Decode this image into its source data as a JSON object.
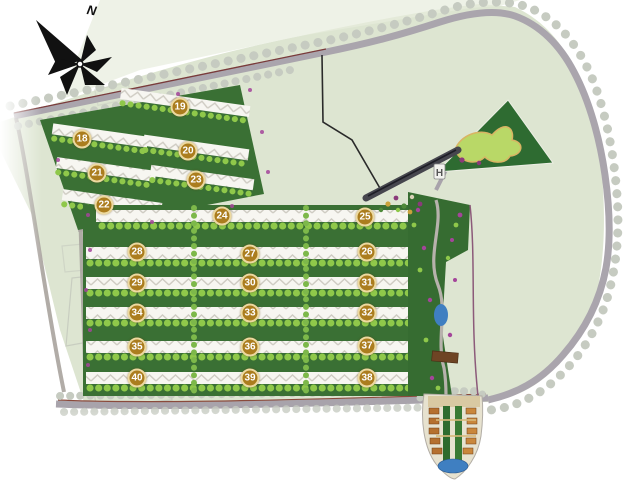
{
  "map": {
    "compass": {
      "label": "N"
    },
    "entrance_marker": {
      "label": "H"
    },
    "building_markers": [
      {
        "label": "18",
        "x": 82,
        "y": 139
      },
      {
        "label": "19",
        "x": 180,
        "y": 107
      },
      {
        "label": "20",
        "x": 188,
        "y": 151
      },
      {
        "label": "21",
        "x": 97,
        "y": 173
      },
      {
        "label": "22",
        "x": 104,
        "y": 205
      },
      {
        "label": "23",
        "x": 196,
        "y": 180
      },
      {
        "label": "24",
        "x": 222,
        "y": 216
      },
      {
        "label": "25",
        "x": 365,
        "y": 217
      },
      {
        "label": "26",
        "x": 367,
        "y": 252
      },
      {
        "label": "27",
        "x": 250,
        "y": 254
      },
      {
        "label": "28",
        "x": 137,
        "y": 252
      },
      {
        "label": "29",
        "x": 137,
        "y": 283
      },
      {
        "label": "30",
        "x": 250,
        "y": 283
      },
      {
        "label": "31",
        "x": 367,
        "y": 283
      },
      {
        "label": "32",
        "x": 367,
        "y": 313
      },
      {
        "label": "33",
        "x": 250,
        "y": 313
      },
      {
        "label": "34",
        "x": 137,
        "y": 313
      },
      {
        "label": "35",
        "x": 137,
        "y": 347
      },
      {
        "label": "36",
        "x": 250,
        "y": 347
      },
      {
        "label": "37",
        "x": 367,
        "y": 346
      },
      {
        "label": "38",
        "x": 367,
        "y": 378
      },
      {
        "label": "39",
        "x": 250,
        "y": 378
      },
      {
        "label": "40",
        "x": 137,
        "y": 378
      }
    ],
    "colors": {
      "site_background": "#dde5d1",
      "road": "#aaa5ad",
      "tree_dot": "#c6cbc1",
      "building_row": "#f7f6f1",
      "greenery_dark": "#3a7034",
      "greenery_light": "#8fc84a",
      "marker_fill": "#ab7d1e",
      "marker_ring": "#ecd9a0",
      "marker_text": "#ffffff",
      "park_dark": "#2e6b31",
      "park_lawn": "#b9d867",
      "water": "#3f7fc1",
      "flower_accent": "#a4459a"
    }
  }
}
